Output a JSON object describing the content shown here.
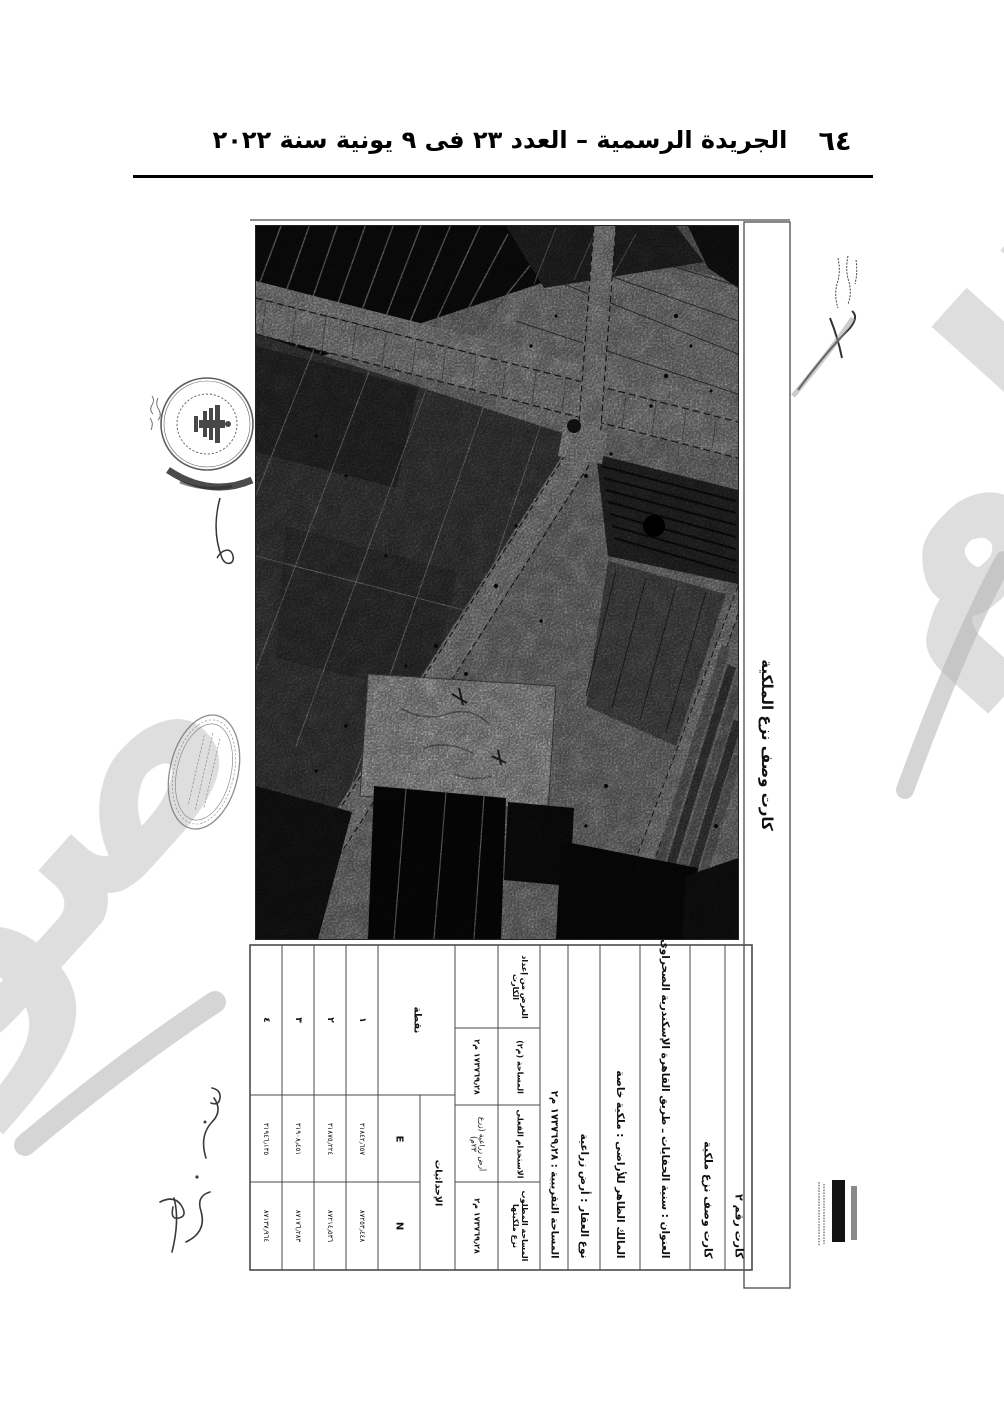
{
  "page_header": {
    "title": "الجريدة الرسمية – العدد ٢٣ فى ٩ يونية سنة ٢٠٢٢",
    "page_number": "٦٤"
  },
  "card": {
    "side_title": "كارت وصف نزع الملكية",
    "info_rows": {
      "card_no": "كارت رقم ٢",
      "subtitle": "كارت وصف نزع ملكية",
      "address": "العنوان : سنية الحفايات ـ طريق القاهرة الإسكندرية الصحراوى",
      "owner": "المالك الظاهر للأراضى : ملكية خاصة",
      "property_type": "نوع العقار : أرض زراعية",
      "approx_area": "المساحة التقريبية : ١٧٣٧٦٩٫٢٨ م٢"
    },
    "fields": [
      {
        "label": "المساحة المطلوب نزع ملكيتها",
        "value": "١٧٣٧٦٩٫٢٨ م٢"
      },
      {
        "label": "الاستخدام الفعلى",
        "value": "أرض زراعية (زرع ٢٣م)"
      },
      {
        "label": "المساحة (م٢)",
        "value": "١٧٣٧٦٩٫٢٨ م٢"
      },
      {
        "label": "الغرض من إعداد الكارت",
        "value": ""
      }
    ],
    "coords": {
      "group_header": "الإحداثيات",
      "point_header": "نقطة",
      "e_label": "E",
      "n_label": "N",
      "rows": [
        {
          "no": "١",
          "e": "٣١٨٤٢٫٦٥٧",
          "n": "٨٧٢٥٣٫٤٤٨"
        },
        {
          "no": "٢",
          "e": "٣١٨٧٥٫٢٢٤",
          "n": "٨٧٢١٤٫٥٣٦"
        },
        {
          "no": "٣",
          "e": "٣١٩٠٨٫٤٥١",
          "n": "٨٧١٧٦٫٢٨٣"
        },
        {
          "no": "٤",
          "e": "٣١٩٤٦٫١٣٥",
          "n": "٨٧١٣٧٫٩٦٤"
        }
      ]
    }
  },
  "annotations": {
    "watermark_fragment_right": "الم",
    "watermark_fragment_bottom_left": "صو"
  }
}
